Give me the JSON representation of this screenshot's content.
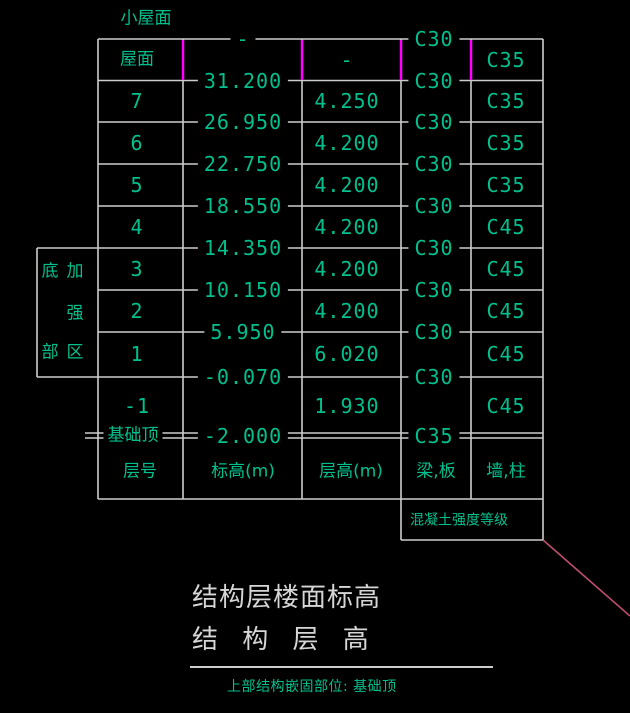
{
  "top_label": "小屋面",
  "table": {
    "col_headers": [
      "层号",
      "标高(m)",
      "层高(m)",
      "梁,板",
      "墙,柱"
    ],
    "rows": [
      {
        "floor": "屋面",
        "story_height": "-",
        "wall_col_grade": "C35"
      },
      {
        "floor": "7",
        "story_height": "4.250",
        "wall_col_grade": "C35"
      },
      {
        "floor": "6",
        "story_height": "4.200",
        "wall_col_grade": "C35"
      },
      {
        "floor": "5",
        "story_height": "4.200",
        "wall_col_grade": "C35"
      },
      {
        "floor": "4",
        "story_height": "4.200",
        "wall_col_grade": "C45"
      },
      {
        "floor": "3",
        "story_height": "4.200",
        "wall_col_grade": "C45"
      },
      {
        "floor": "2",
        "story_height": "4.200",
        "wall_col_grade": "C45"
      },
      {
        "floor": "1",
        "story_height": "6.020",
        "wall_col_grade": "C45"
      },
      {
        "floor": "-1",
        "story_height": "1.930",
        "wall_col_grade": "C45"
      }
    ],
    "elevations_on_lines": [
      "-",
      "31.200",
      "26.950",
      "22.750",
      "18.550",
      "14.350",
      "10.150",
      "5.950",
      "-0.070",
      "-2.000"
    ],
    "beam_slab_grades_on_lines": [
      "C30",
      "C30",
      "C30",
      "C30",
      "C30",
      "C30",
      "C30",
      "C30",
      "C30",
      "C35"
    ],
    "foundation_top_label": "基础顶",
    "concrete_grade_label": "混凝土强度等级"
  },
  "left_box": {
    "chars": [
      "底",
      "加",
      "强",
      "部",
      "区"
    ]
  },
  "footer": {
    "title_line1": "结构层楼面标高",
    "title_line2": "结 构 层 高",
    "note": "上部结构嵌固部位: 基础顶"
  },
  "colors": {
    "background": "#000000",
    "text_green": "#00c08e",
    "line_gray": "#cdcdcd",
    "text_white": "#d6d6d6",
    "tick_magenta": "#ff00ff",
    "leader_red": "#c04f6e"
  }
}
